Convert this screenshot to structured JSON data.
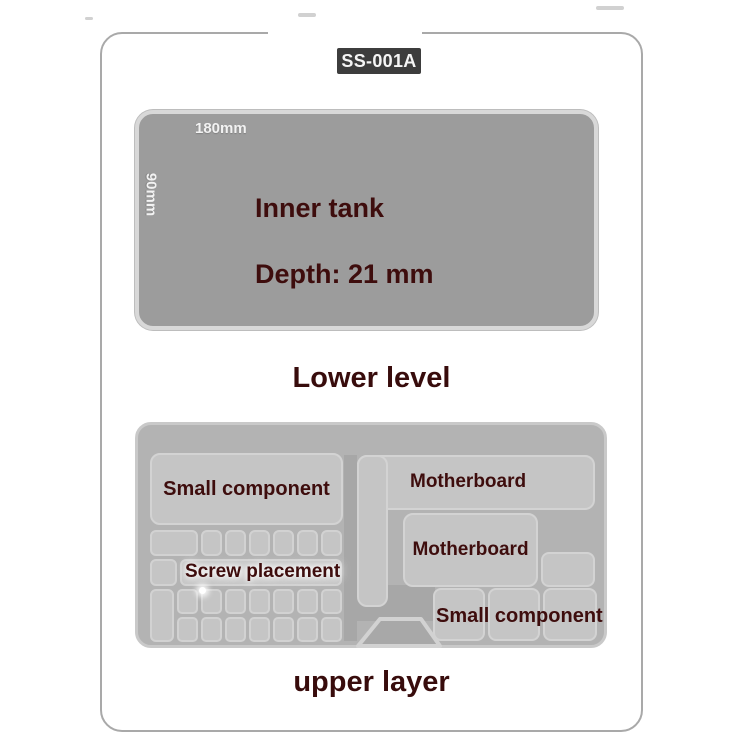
{
  "badge": {
    "model": "SS-001A"
  },
  "lower_level": {
    "tank": {
      "width_dim": "180mm",
      "depth_dim": "90mm",
      "line1": "Inner tank",
      "line2": "Depth: 21 mm"
    },
    "caption": "Lower level"
  },
  "upper_layer": {
    "caption": "upper layer",
    "left_section": {
      "small_component_label": "Small component",
      "screw_placement_label": "Screw placement",
      "screw_grid": {
        "row1_keys": 6,
        "row1_wide_keys": 1,
        "row2_keys": 1,
        "row2_bars": 1,
        "row3_keys": 7,
        "row4_keys": 7,
        "tall_keys": 1
      }
    },
    "right_section": {
      "motherboard_top_label": "Motherboard",
      "motherboard_mid_label": "Motherboard",
      "small_component_label": "Small component"
    }
  },
  "colors": {
    "frame_border": "#a9a9a9",
    "badge_bg": "#3d3d3d",
    "badge_text": "#f5f5f5",
    "tank_fill": "#9c9c9c",
    "tank_rim": "#d8d8d8",
    "dim_text": "#f2f2f2",
    "label_maroon": "#3e0d0d",
    "tray_fill": "#b3b3b3",
    "tray_rim": "#c9c9c9",
    "cell_fill": "#c5c5c5",
    "cell_border": "#d3d3d3",
    "gap_fill": "#a7a7a7"
  }
}
